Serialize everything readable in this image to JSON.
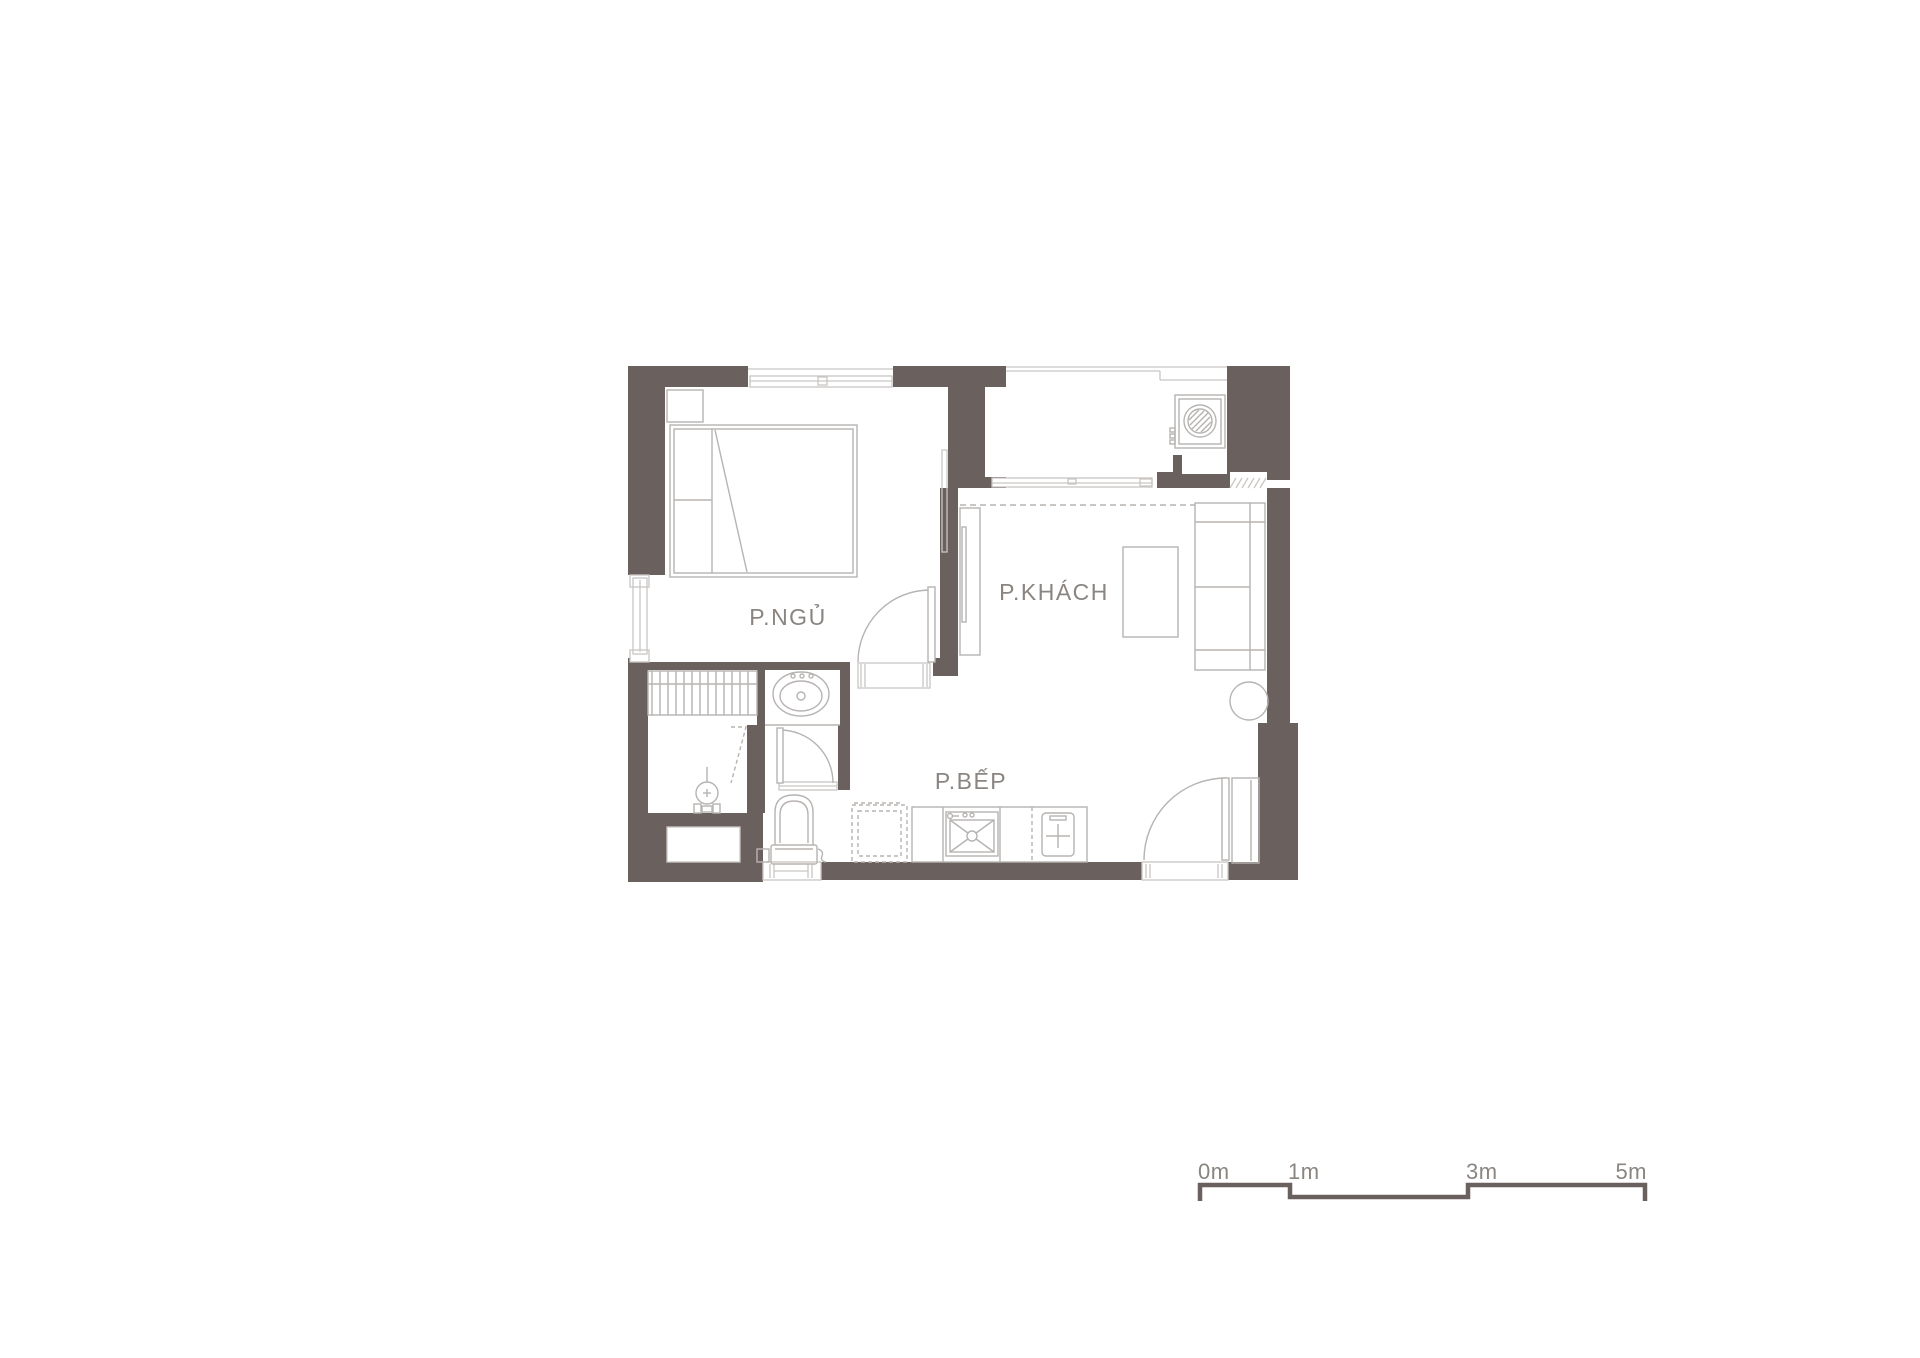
{
  "plan": {
    "rooms": {
      "bedroom": {
        "label": "P.NGỦ"
      },
      "living_room": {
        "label": "P.KHÁCH"
      },
      "kitchen": {
        "label": "P.BẾP"
      }
    },
    "colors": {
      "wall": "#6a615f",
      "furniture_line": "#b7b3b1",
      "window_line": "#c9c6c4",
      "label_text": "#8a8581"
    },
    "fixtures": [
      "bed",
      "pillows",
      "nightstand",
      "wardrobe",
      "sliding-panel",
      "tv-console",
      "tv",
      "coffee-table",
      "sofa",
      "side-table",
      "washing-machine",
      "balcony-sliding-door",
      "balcony-railing",
      "kitchen-counter",
      "kitchen-sink",
      "cooktop",
      "dashed-appliance",
      "refrigerator",
      "vanity-sink",
      "toilet",
      "shower-mixer",
      "bedroom-door",
      "bathroom-door",
      "entry-door",
      "bedroom-window",
      "side-window",
      "bathroom-window"
    ]
  },
  "scale_bar": {
    "unit": "m",
    "tick_values": [
      0,
      1,
      3,
      5
    ],
    "labels": [
      "0m",
      "1m",
      "3m",
      "5m"
    ]
  }
}
